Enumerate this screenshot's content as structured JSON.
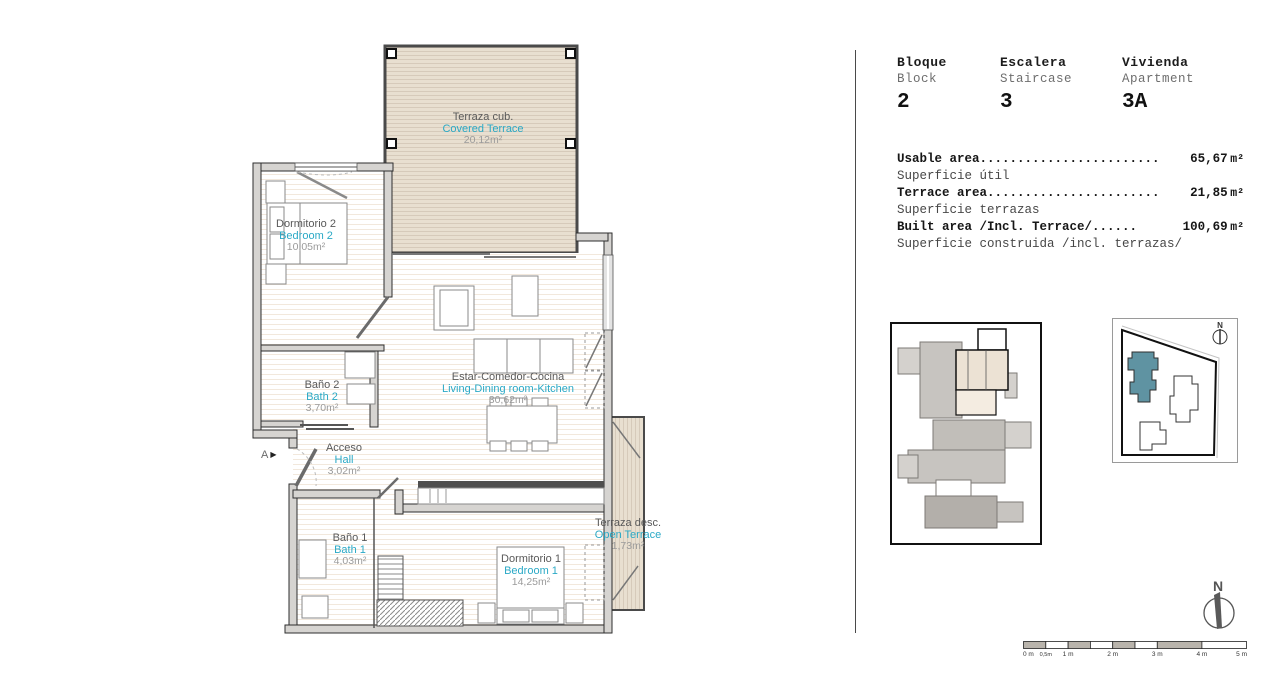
{
  "header": {
    "block": {
      "label_es": "Bloque",
      "label_en": "Block",
      "value": "2"
    },
    "staircase": {
      "label_es": "Escalera",
      "label_en": "Staircase",
      "value": "3"
    },
    "apartment": {
      "label_es": "Vivienda",
      "label_en": "Apartment",
      "value": "3A"
    }
  },
  "areas": [
    {
      "label_en": "Usable area",
      "dots": "........................",
      "value": "65,67",
      "unit": "m²",
      "label_es": "Superficie útil"
    },
    {
      "label_en": "Terrace area",
      "dots": ".......................",
      "value": "21,85",
      "unit": "m²",
      "label_es": "Superficie terrazas"
    },
    {
      "label_en": "Built area /Incl. Terrace/",
      "dots": " ......",
      "value": "100,69",
      "unit": "m²",
      "label_es": "Superficie construida /incl. terrazas/"
    }
  ],
  "rooms": {
    "covered_terrace": {
      "name_es": "Terraza cub.",
      "name_en": "Covered Terrace",
      "area": "20,12m²"
    },
    "bedroom_2": {
      "name_es": "Dormitorio 2",
      "name_en": "Bedroom 2",
      "area": "10,05m²"
    },
    "bath_2": {
      "name_es": "Baño 2",
      "name_en": "Bath 2",
      "area": "3,70m²"
    },
    "hall": {
      "name_es": "Acceso",
      "name_en": "Hall",
      "area": "3,02m²"
    },
    "living": {
      "name_es": "Estar-Comedor-Cocina",
      "name_en": "Living-Dining room-Kitchen",
      "area": "30,62m²"
    },
    "bath_1": {
      "name_es": "Baño 1",
      "name_en": "Bath 1",
      "area": "4,03m²"
    },
    "bedroom_1": {
      "name_es": "Dormitorio 1",
      "name_en": "Bedroom 1",
      "area": "14,25m²"
    },
    "open_terrace": {
      "name_es": "Terraza desc.",
      "name_en": "Open Terrace",
      "area": "1,73m²"
    }
  },
  "section_marker": {
    "label": "A",
    "arrow_glyph": "▶"
  },
  "compass": {
    "label": "N"
  },
  "site_plan": {
    "north_label": "N"
  },
  "scale_bar": {
    "labels": [
      "0 m",
      "0,5m",
      "1 m",
      "2 m",
      "3 m",
      "4 m",
      "5 m"
    ]
  },
  "colors": {
    "accent_cyan": "#2aa9c6",
    "label_gray": "#595959",
    "area_gray": "#9b9b9b",
    "wall_fill": "#d6d4d1",
    "deck_beige": "#e8dfd0",
    "highlight_teal": "#5f93a2",
    "keyplan_highlight": "#ece2d4"
  }
}
